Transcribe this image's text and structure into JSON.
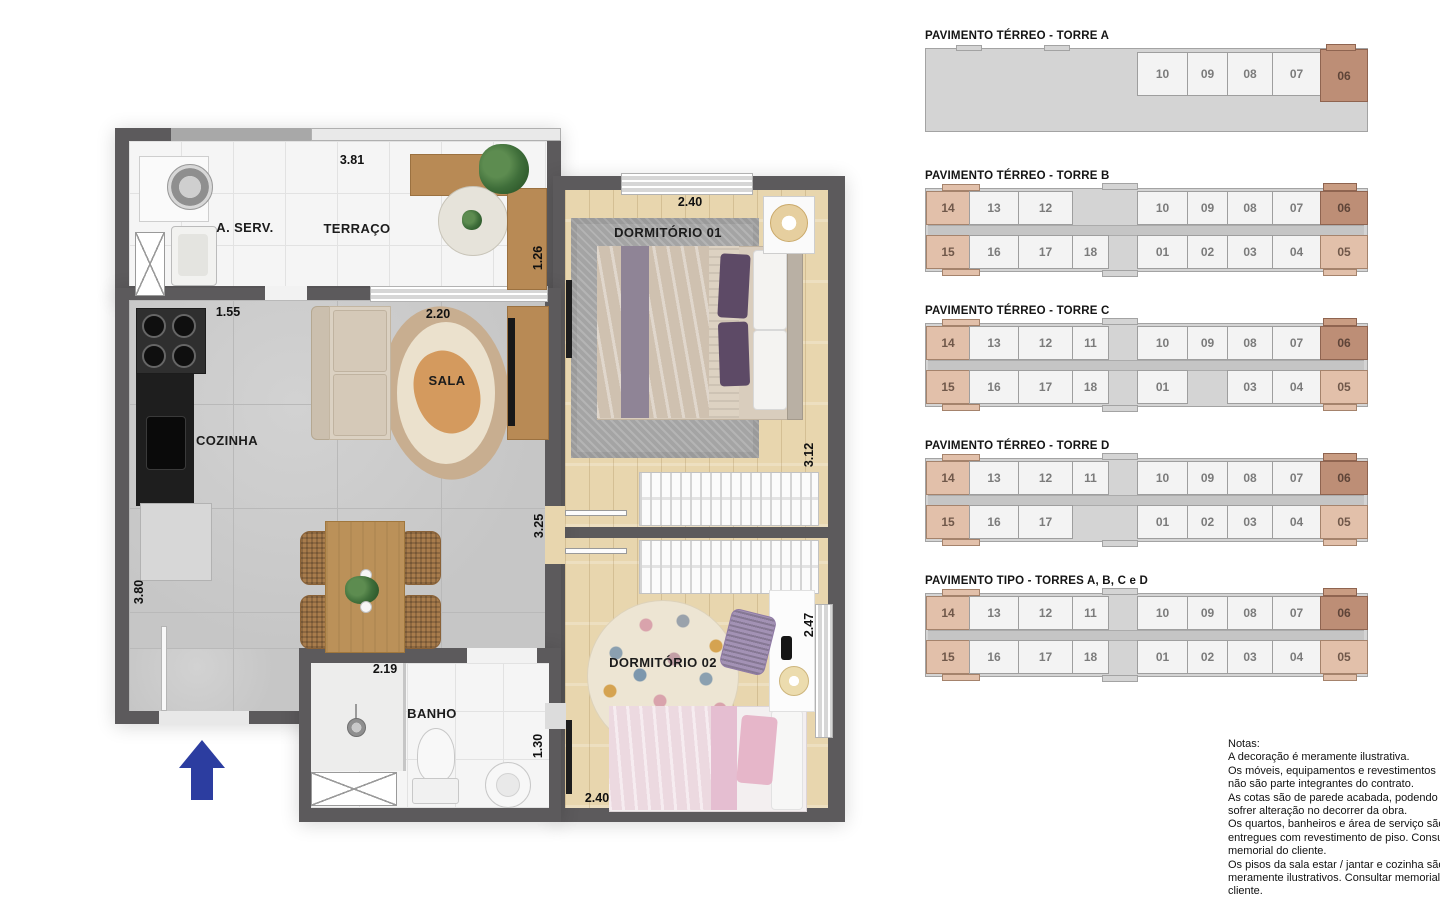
{
  "floor_plan": {
    "rooms": {
      "a_serv": "A. SERV.",
      "terraco": "TERRAÇO",
      "dormitorio_01": "DORMITÓRIO 01",
      "sala": "SALA",
      "cozinha": "COZINHA",
      "dormitorio_02": "DORMITÓRIO 02",
      "banho": "BANHO"
    },
    "dims": {
      "terraco_w": "3.81",
      "dorm1_w": "2.40",
      "terraco_d": "1.26",
      "cozinha_w": "1.55",
      "sala_w": "2.20",
      "dorm1_d": "3.12",
      "sala_d": "3.25",
      "dorm2_d": "2.47",
      "cozinha_d": "3.80",
      "banho_w": "2.19",
      "banho_d": "1.30",
      "dorm2_w": "2.40"
    }
  },
  "key_plans": [
    {
      "title": "PAVIMENTO TÉRREO - TORRE A",
      "corridor": false,
      "top": [
        null,
        null,
        null,
        null,
        null,
        {
          "n": "10",
          "s": "u"
        },
        {
          "n": "09",
          "s": "u"
        },
        {
          "n": "08",
          "s": "u"
        },
        {
          "n": "07",
          "s": "u"
        },
        {
          "n": "06",
          "s": "d"
        }
      ],
      "bottom": [
        null,
        null,
        null,
        null,
        null,
        null,
        null,
        null,
        null,
        null
      ]
    },
    {
      "title": "PAVIMENTO TÉRREO - TORRE B",
      "corridor": true,
      "top": [
        {
          "n": "14",
          "s": "h"
        },
        {
          "n": "13",
          "s": "u"
        },
        {
          "n": "12",
          "s": "u"
        },
        null,
        null,
        {
          "n": "10",
          "s": "u"
        },
        {
          "n": "09",
          "s": "u"
        },
        {
          "n": "08",
          "s": "u"
        },
        {
          "n": "07",
          "s": "u"
        },
        {
          "n": "06",
          "s": "d"
        }
      ],
      "bottom": [
        {
          "n": "15",
          "s": "h"
        },
        {
          "n": "16",
          "s": "u"
        },
        {
          "n": "17",
          "s": "u"
        },
        {
          "n": "18",
          "s": "u"
        },
        null,
        {
          "n": "01",
          "s": "u"
        },
        {
          "n": "02",
          "s": "u"
        },
        {
          "n": "03",
          "s": "u"
        },
        {
          "n": "04",
          "s": "u"
        },
        {
          "n": "05",
          "s": "h"
        }
      ]
    },
    {
      "title": "PAVIMENTO TÉRREO - TORRE C",
      "corridor": true,
      "top": [
        {
          "n": "14",
          "s": "h"
        },
        {
          "n": "13",
          "s": "u"
        },
        {
          "n": "12",
          "s": "u"
        },
        {
          "n": "11",
          "s": "u"
        },
        null,
        {
          "n": "10",
          "s": "u"
        },
        {
          "n": "09",
          "s": "u"
        },
        {
          "n": "08",
          "s": "u"
        },
        {
          "n": "07",
          "s": "u"
        },
        {
          "n": "06",
          "s": "d"
        }
      ],
      "bottom": [
        {
          "n": "15",
          "s": "h"
        },
        {
          "n": "16",
          "s": "u"
        },
        {
          "n": "17",
          "s": "u"
        },
        {
          "n": "18",
          "s": "u"
        },
        null,
        {
          "n": "01",
          "s": "u"
        },
        null,
        {
          "n": "03",
          "s": "u"
        },
        {
          "n": "04",
          "s": "u"
        },
        {
          "n": "05",
          "s": "h"
        }
      ]
    },
    {
      "title": "PAVIMENTO TÉRREO - TORRE D",
      "corridor": true,
      "top": [
        {
          "n": "14",
          "s": "h"
        },
        {
          "n": "13",
          "s": "u"
        },
        {
          "n": "12",
          "s": "u"
        },
        {
          "n": "11",
          "s": "u"
        },
        null,
        {
          "n": "10",
          "s": "u"
        },
        {
          "n": "09",
          "s": "u"
        },
        {
          "n": "08",
          "s": "u"
        },
        {
          "n": "07",
          "s": "u"
        },
        {
          "n": "06",
          "s": "d"
        }
      ],
      "bottom": [
        {
          "n": "15",
          "s": "h"
        },
        {
          "n": "16",
          "s": "u"
        },
        {
          "n": "17",
          "s": "u"
        },
        null,
        null,
        {
          "n": "01",
          "s": "u"
        },
        {
          "n": "02",
          "s": "u"
        },
        {
          "n": "03",
          "s": "u"
        },
        {
          "n": "04",
          "s": "u"
        },
        {
          "n": "05",
          "s": "h"
        }
      ]
    },
    {
      "title": "PAVIMENTO TIPO - TORRES A, B, C e D",
      "corridor": true,
      "top": [
        {
          "n": "14",
          "s": "h"
        },
        {
          "n": "13",
          "s": "u"
        },
        {
          "n": "12",
          "s": "u"
        },
        {
          "n": "11",
          "s": "u"
        },
        null,
        {
          "n": "10",
          "s": "u"
        },
        {
          "n": "09",
          "s": "u"
        },
        {
          "n": "08",
          "s": "u"
        },
        {
          "n": "07",
          "s": "u"
        },
        {
          "n": "06",
          "s": "d"
        }
      ],
      "bottom": [
        {
          "n": "15",
          "s": "h"
        },
        {
          "n": "16",
          "s": "u"
        },
        {
          "n": "17",
          "s": "u"
        },
        {
          "n": "18",
          "s": "u"
        },
        null,
        {
          "n": "01",
          "s": "u"
        },
        {
          "n": "02",
          "s": "u"
        },
        {
          "n": "03",
          "s": "u"
        },
        {
          "n": "04",
          "s": "u"
        },
        {
          "n": "05",
          "s": "h"
        }
      ]
    }
  ],
  "notes": {
    "lines": [
      "Notas:",
      "A decoração é meramente ilustrativa.",
      "Os móveis, equipamentos e revestimentos",
      "não são parte integrantes do contrato.",
      "As cotas são de parede acabada, podendo",
      "sofrer alteração no decorrer da obra.",
      "Os quartos, banheiros e área de serviço são",
      "entregues com revestimento de piso. Consultar",
      "memorial do cliente.",
      "Os pisos da sala estar / jantar e cozinha são",
      "meramente ilustrativos. Consultar memorial do",
      "cliente."
    ]
  },
  "colors": {
    "wall": "#5c5a5c",
    "building_gray": "#d4d4d4",
    "highlight_light": "#e2c0aa",
    "highlight_dark": "#bd8e76",
    "arrow_blue": "#2c3da0"
  }
}
